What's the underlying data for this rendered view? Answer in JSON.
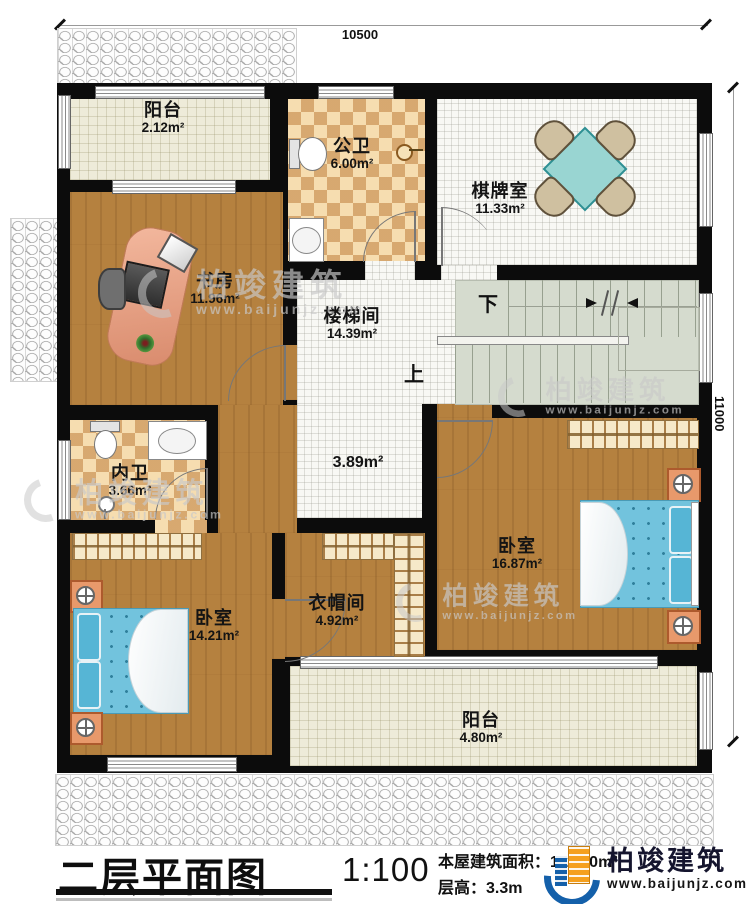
{
  "dimensions": {
    "top": "10500",
    "right": "11000"
  },
  "rooms": [
    {
      "id": "balcony-top",
      "name": "阳台",
      "area": "2.12m²"
    },
    {
      "id": "public-bath",
      "name": "公卫",
      "area": "6.00m²"
    },
    {
      "id": "chess-room",
      "name": "棋牌室",
      "area": "11.33m²"
    },
    {
      "id": "study",
      "name": "书房",
      "area": "11.96m²"
    },
    {
      "id": "stairwell",
      "name": "楼梯间",
      "area": "14.39m²"
    },
    {
      "id": "hall",
      "name": "",
      "area": "3.89m²"
    },
    {
      "id": "inner-bath",
      "name": "内卫",
      "area": "3.66m²"
    },
    {
      "id": "bedroom-right",
      "name": "卧室",
      "area": "16.87m²"
    },
    {
      "id": "cloakroom",
      "name": "衣帽间",
      "area": "4.92m²"
    },
    {
      "id": "bedroom-left",
      "name": "卧室",
      "area": "14.21m²"
    },
    {
      "id": "balcony-bottom",
      "name": "阳台",
      "area": "4.80m²"
    }
  ],
  "stairs": {
    "up": "上",
    "down": "下"
  },
  "watermark": {
    "brand": "柏竣建筑",
    "url": "www.baijunjz.com"
  },
  "footer": {
    "title": "二层平面图",
    "scale": "1:100",
    "area_label": "本屋建筑面积：",
    "area_value": "112.90m²",
    "floor_height_label": "层高：",
    "floor_height_value": "3.3m",
    "brand": "柏竣建筑",
    "url": "www.baijunjz.com"
  },
  "colors": {
    "wall": "#0c0c0c",
    "wood_floor": "#b5813f",
    "tile_light": "#f6ddb0",
    "tile_dark": "#cf9a62",
    "white_tile": "#f8f8f4",
    "balcony_cream": "#eeebd9",
    "stair_green": "#d5dbce",
    "bed_blue": "#72c3dd",
    "nightstand_orange": "#e8996b",
    "table_teal": "#99d5d2",
    "brand_blue": "#1460aa",
    "brand_orange": "#f5a01e"
  }
}
